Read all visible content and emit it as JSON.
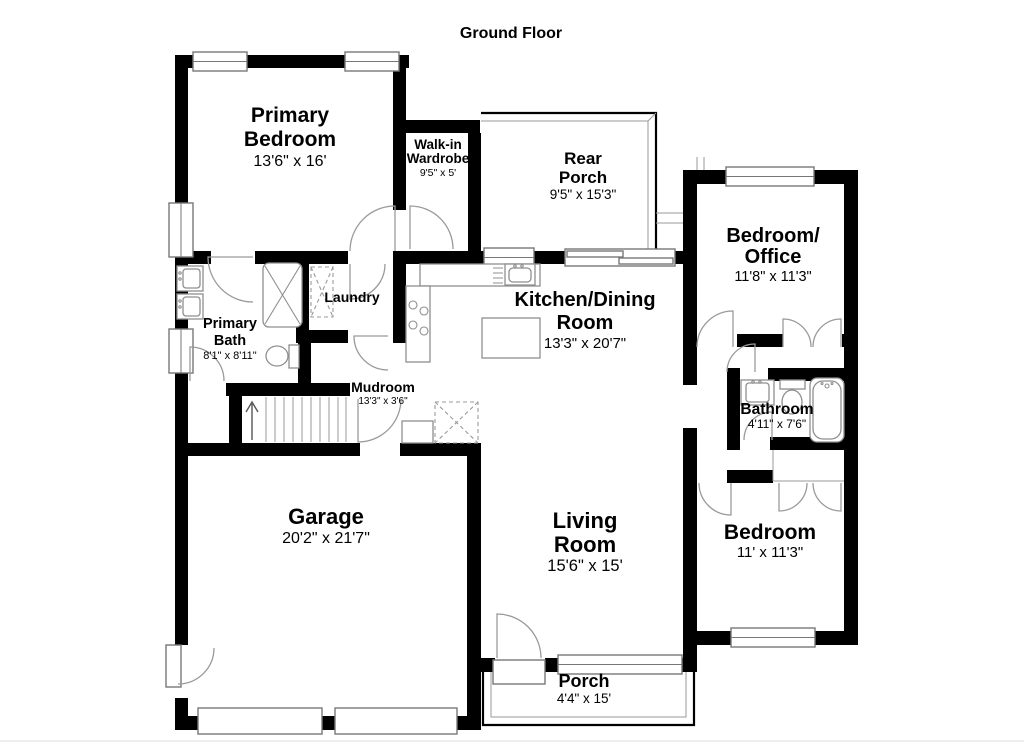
{
  "title": "Ground Floor",
  "colors": {
    "walls": "#000000",
    "fixture_outline": "#8f8f8f",
    "background": "#ffffff"
  },
  "rooms": {
    "primary_bedroom": {
      "line1": "Primary",
      "line2": "Bedroom",
      "dims": "13'6\" x 16'"
    },
    "walkin_wardrobe": {
      "line1": "Walk-in",
      "line2": "Wardrobe",
      "dims": "9'5\" x 5'"
    },
    "rear_porch": {
      "line1": "Rear",
      "line2": "Porch",
      "dims": "9'5\" x 15'3\""
    },
    "bedroom_office": {
      "line1": "Bedroom/",
      "line2": "Office",
      "dims": "11'8\" x 11'3\""
    },
    "primary_bath": {
      "line1": "Primary",
      "line2": "Bath",
      "dims": "8'1\" x 8'11\""
    },
    "laundry": {
      "line1": "Laundry"
    },
    "kitchen_dining": {
      "line1": "Kitchen/Dining",
      "line2": "Room",
      "dims": "13'3\" x 20'7\""
    },
    "mudroom": {
      "line1": "Mudroom",
      "dims": "13'3\" x 3'6\""
    },
    "bathroom": {
      "line1": "Bathroom",
      "dims": "4'11\" x 7'6\""
    },
    "garage": {
      "line1": "Garage",
      "dims": "20'2\" x 21'7\""
    },
    "living_room": {
      "line1": "Living",
      "line2": "Room",
      "dims": "15'6\" x 15'"
    },
    "bedroom": {
      "line1": "Bedroom",
      "dims": "11' x 11'3\""
    },
    "porch": {
      "line1": "Porch",
      "dims": "4'4\" x 15'"
    }
  }
}
